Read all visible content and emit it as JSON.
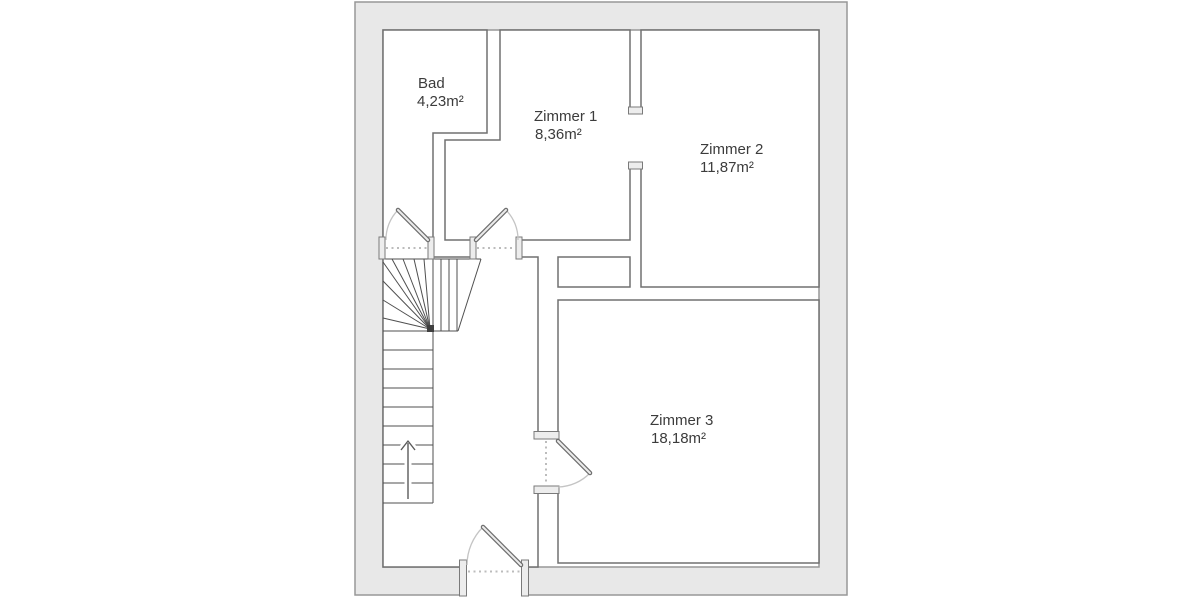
{
  "plan": {
    "title": "floor-plan",
    "rooms": [
      {
        "id": "bad",
        "name": "Bad",
        "area": "4,23m²"
      },
      {
        "id": "zimmer1",
        "name": "Zimmer 1",
        "area": "8,36m²"
      },
      {
        "id": "zimmer2",
        "name": "Zimmer 2",
        "area": "11,87m²"
      },
      {
        "id": "zimmer3",
        "name": "Zimmer 3",
        "area": "18,18m²"
      }
    ],
    "stairs": {
      "arrow_direction": "up"
    },
    "colors": {
      "wall_fill": "#e8e8e8",
      "wall_stroke": "#979797",
      "room_stroke": "#707070",
      "stair_stroke": "#4f4f4f",
      "door_arc": "#c4c4c4",
      "dotted": "#bcbcbc",
      "leaf_dark": "#6f6f6f",
      "leaf_light": "#ececec",
      "jamb_fill": "#ededed",
      "jamb_stroke": "#7a7a7a",
      "text": "#3c3c3c",
      "background": "#ffffff"
    }
  }
}
